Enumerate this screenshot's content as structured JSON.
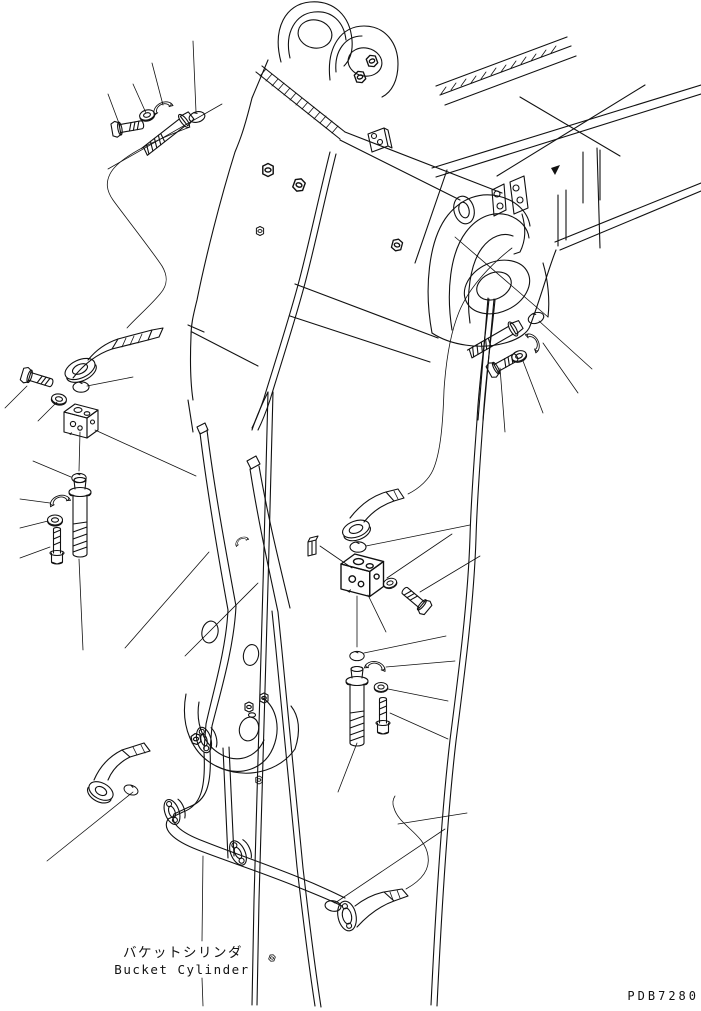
{
  "document": {
    "kind": "excavator-arm-bucket-cylinder-piping-parts-diagram",
    "caption_jp": "バケットシリンダ",
    "caption_en": "Bucket Cylinder",
    "drawing_code": "PDB7280"
  },
  "colors": {
    "line": "#111111",
    "background": "#ffffff"
  }
}
